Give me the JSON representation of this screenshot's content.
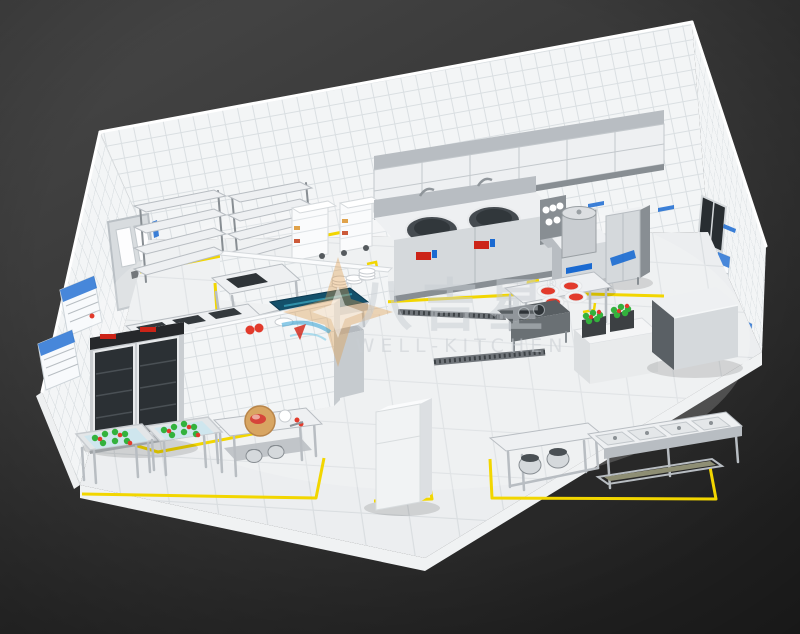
{
  "watermark": {
    "brand_cn": "八吉星",
    "registered": "®",
    "brand_en": "WELL-KITCHEN"
  },
  "colors": {
    "background_top": "#484848",
    "background_bottom": "#232323",
    "wall_face": "#f3f5f6",
    "wall_grid": "#dadfe2",
    "floor_face": "#eceef0",
    "floor_grid": "#d9dde0",
    "slab_edge": "#f0f2f3",
    "marking_yellow": "#f2d600",
    "steel_light": "#eef0f2",
    "steel_front": "#d5d9dc",
    "steel_mid": "#b8bdc2",
    "steel_deep": "#888e93",
    "steel_dark": "#5a6065",
    "glass_dark": "#282d31",
    "equip_white": "#fafbfc",
    "sign_blue": "#1a6ad1",
    "control_red": "#cc2418",
    "tomato_red": "#e23a2b",
    "veg_green": "#33b23d",
    "water_blue": "#cfe6ee",
    "wood_tan": "#d8a562",
    "teal_top": "#14506a",
    "watermark_gray": "#c9ced3"
  },
  "equipment": [
    {
      "label": "Exhaust hood"
    },
    {
      "label": "Storage shelving racks"
    },
    {
      "label": "Rice steamer carts"
    },
    {
      "label": "Double wok range"
    },
    {
      "label": "Condiment rack"
    },
    {
      "label": "Soup kettle"
    },
    {
      "label": "Steam cabinet"
    },
    {
      "label": "Tiled half wall"
    },
    {
      "label": "Prep sink table"
    },
    {
      "label": "Plate stacks"
    },
    {
      "label": "Blue-top work table"
    },
    {
      "label": "Sink work tables"
    },
    {
      "label": "Tiled partition wall"
    },
    {
      "label": "Plating table with red dishes"
    },
    {
      "label": "Pot sink unit"
    },
    {
      "label": "Vegetable crate counter"
    },
    {
      "label": "Stainless cabinet"
    },
    {
      "label": "Two-door display fridge"
    },
    {
      "label": "Vegetable washing sinks"
    },
    {
      "label": "Cutting-board prep table"
    },
    {
      "label": "Tall storage cabinet"
    },
    {
      "label": "Serving counter with pots"
    },
    {
      "label": "Four-pan hot line"
    },
    {
      "label": "Service door"
    },
    {
      "label": "Window"
    },
    {
      "label": "Wall posters"
    },
    {
      "label": "Wall signs"
    },
    {
      "label": "Floor drains"
    },
    {
      "label": "Yellow floor markings"
    }
  ]
}
